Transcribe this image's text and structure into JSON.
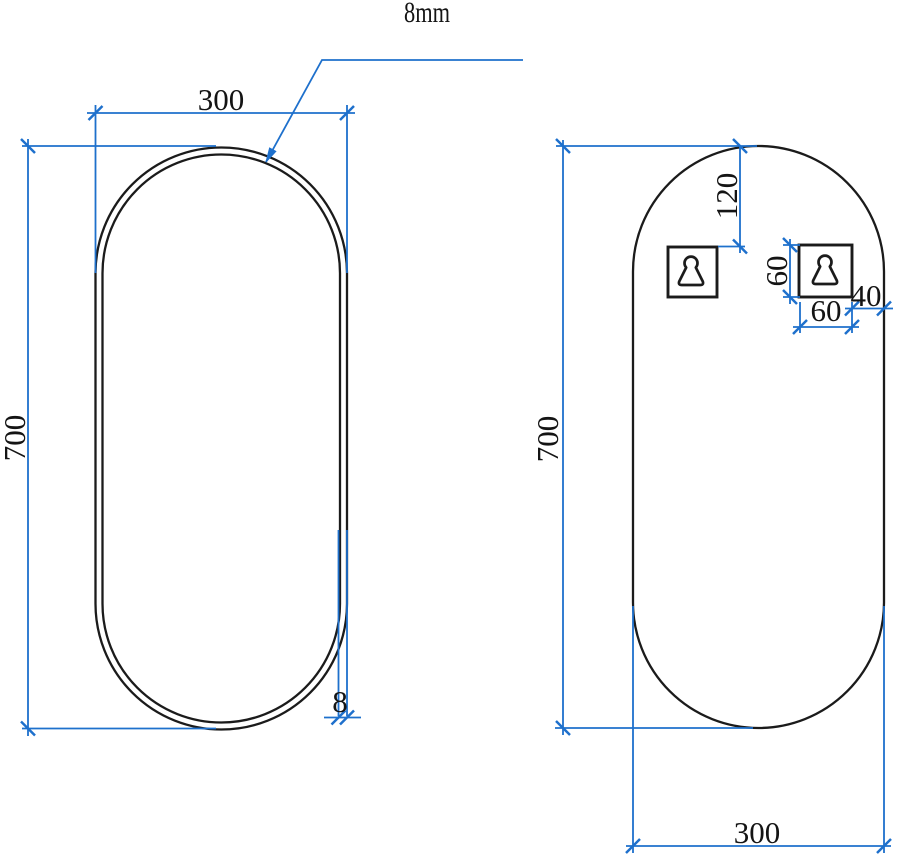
{
  "drawing": {
    "type": "mirror-dimension-diagram",
    "views": {
      "front_view": {
        "name": "front view with frame",
        "width_mm": "300",
        "height_mm": "700",
        "frame_thickness_mm": "8",
        "glass_thickness_label": "8mm"
      },
      "back_view": {
        "name": "back view with hanger brackets",
        "height_mm": "700",
        "width_mm": "300",
        "hanger_top_offset_mm": "120",
        "hanger_height_mm": "60",
        "hanger_width_mm": "60",
        "hanger_side_offset_mm": "40"
      }
    },
    "icons": {
      "hanger_bracket": "keyhole-hanger-icon"
    },
    "colors": {
      "dimension": "#1e70cc",
      "outline": "#1b1b1b",
      "text": "#141414",
      "background": "#ffffff"
    }
  }
}
